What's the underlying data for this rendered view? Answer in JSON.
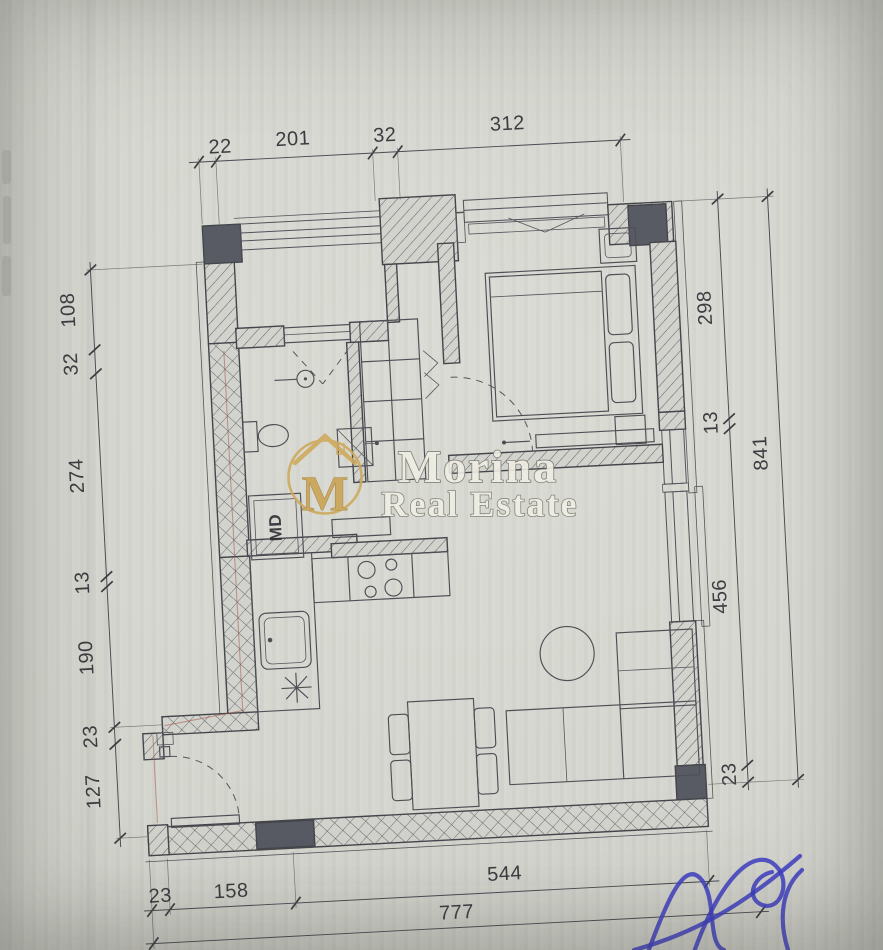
{
  "watermark": {
    "monogram": "M",
    "brand": "Morina",
    "brand2": "Real Estate"
  },
  "plan": {
    "appliance_label": "MD"
  },
  "dimensions": {
    "top": [
      "22",
      "201",
      "32",
      "312"
    ],
    "left": [
      "108",
      "32",
      "274",
      "13",
      "190",
      "23",
      "127"
    ],
    "right": [
      "298",
      "13",
      "456",
      "23"
    ],
    "right_total": "841",
    "bottom": [
      "23",
      "158",
      "544"
    ],
    "bottom_total": "777"
  },
  "colors": {
    "paper": "#d5d6cf",
    "ink": "#45464c",
    "column_fill": "#585b63",
    "watermark_gold": "#cda85c",
    "watermark_text": "#f0eee5",
    "signature_blue": "#3d3dc4",
    "pipe_red": "#a4524a"
  }
}
